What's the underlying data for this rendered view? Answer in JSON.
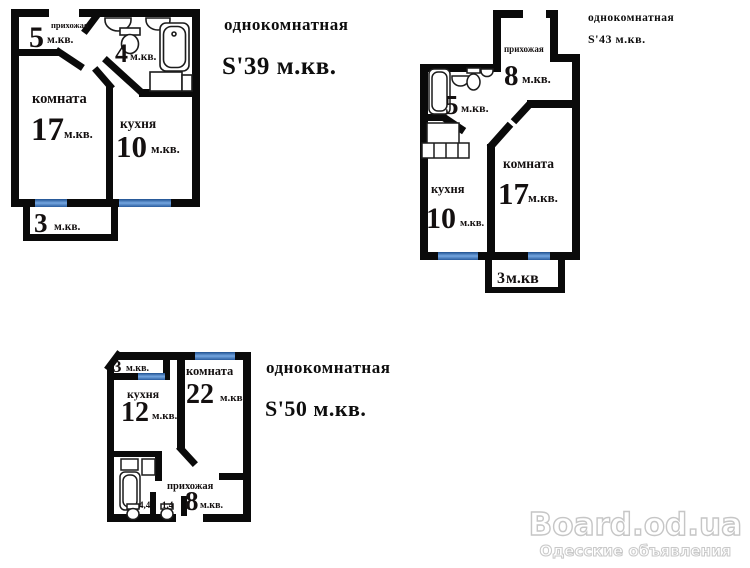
{
  "watermark": {
    "site": "Board.od.ua",
    "tagline": "Одесские объявления"
  },
  "colors": {
    "wall": "#0a0a0a",
    "window": "#4d84c8",
    "text": "#141010",
    "watermark_outline": "#c6c6c6"
  },
  "plans": [
    {
      "title": "однокомнатная",
      "total_area": "S'39 м.кв.",
      "rooms": {
        "hallway": {
          "label": "прихожая",
          "value": "5",
          "unit": "м.кв."
        },
        "bathroom": {
          "value": "4",
          "unit": "м.кв."
        },
        "living": {
          "label": "комната",
          "value": "17",
          "unit": "м.кв."
        },
        "kitchen": {
          "label": "кухня",
          "value": "10",
          "unit": "м.кв."
        },
        "balcony": {
          "value": "3",
          "unit": "м.кв."
        }
      }
    },
    {
      "title": "однокомнатная",
      "total_area": "S'43 м.кв.",
      "rooms": {
        "hallway": {
          "label": "прихожая",
          "value": "8",
          "unit": "м.кв."
        },
        "bathroom": {
          "value": "5",
          "unit": "м.кв."
        },
        "living": {
          "label": "комната",
          "value": "17",
          "unit": "м.кв."
        },
        "kitchen": {
          "label": "кухня",
          "value": "10",
          "unit": "м.кв."
        },
        "balcony": {
          "value": "3",
          "unit": "м.кв"
        }
      }
    },
    {
      "title": "однокомнатная",
      "total_area": "S'50 м.кв.",
      "rooms": {
        "balcony": {
          "value": "3",
          "unit": "м.кв."
        },
        "kitchen": {
          "label": "кухня",
          "value": "12",
          "unit": "м.кв."
        },
        "living": {
          "label": "комната",
          "value": "22",
          "unit": "м.кв."
        },
        "hallway": {
          "label": "прихожая",
          "value": "8",
          "unit": "м.кв."
        },
        "wc_area_1": {
          "value": "4,4"
        },
        "wc_area_2": {
          "value": "1,4"
        }
      }
    }
  ]
}
